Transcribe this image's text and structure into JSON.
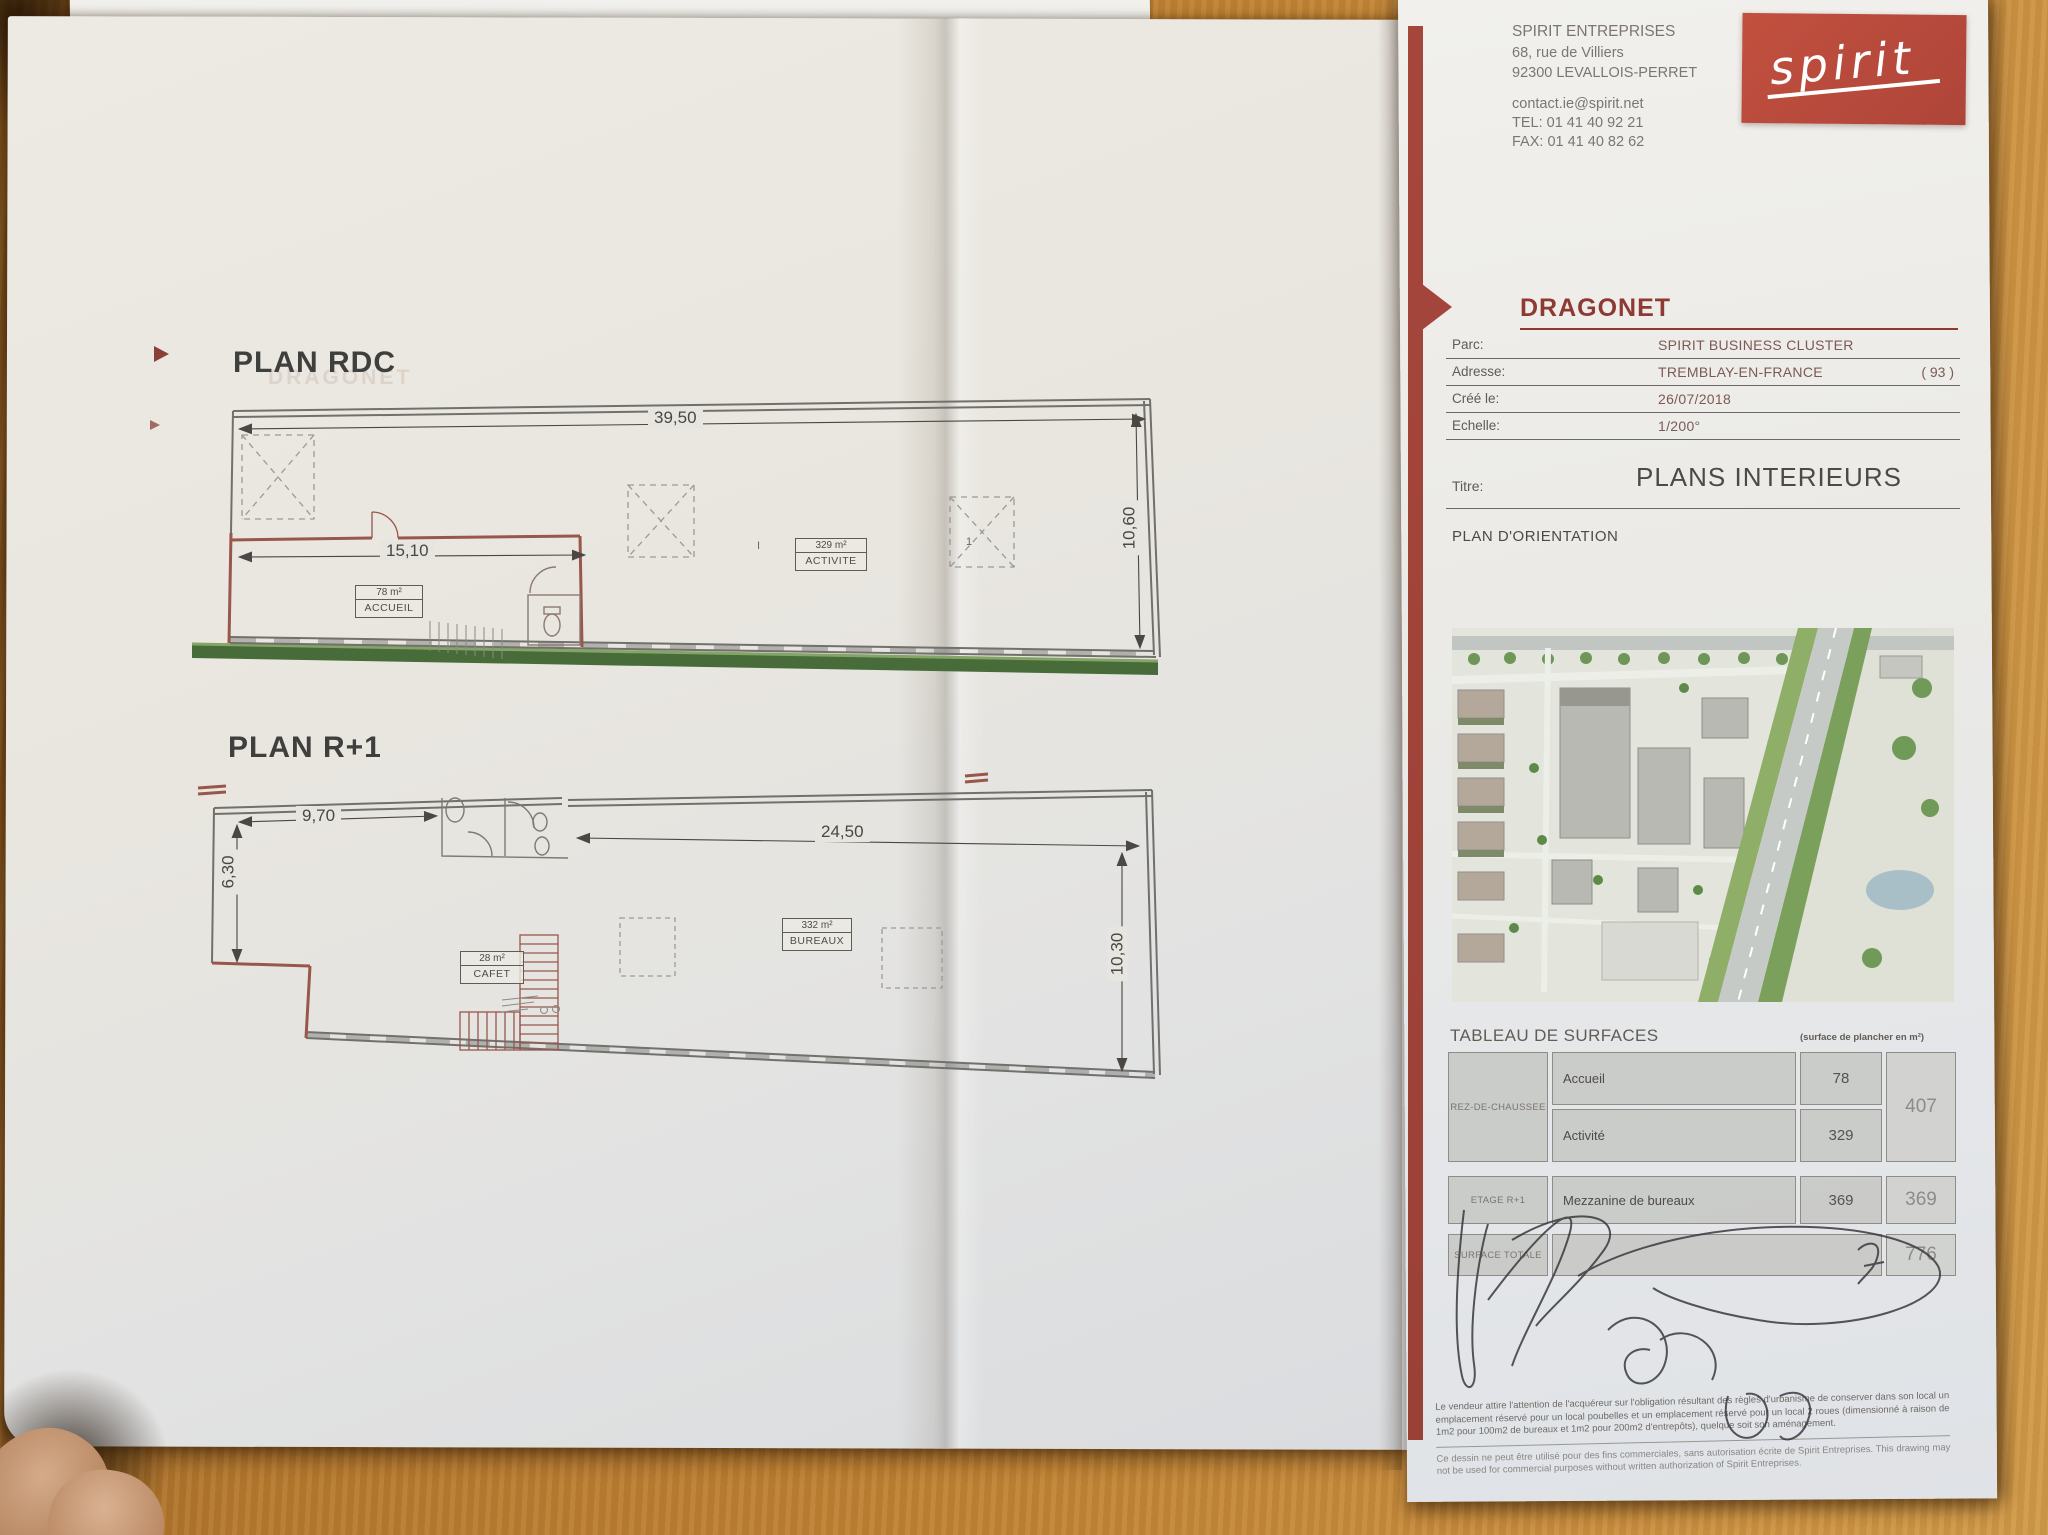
{
  "company": {
    "name": "SPIRIT ENTREPRISES",
    "address1": "68, rue de Villiers",
    "address2": "92300 LEVALLOIS-PERRET",
    "email": "contact.ie@spirit.net",
    "tel": "TEL: 01 41 40 92 21",
    "fax": "FAX: 01 41 40 82 62",
    "logo_text": "spirit"
  },
  "title_block": {
    "project": "DRAGONET",
    "fields": [
      {
        "label": "Parc:",
        "value": "SPIRIT BUSINESS CLUSTER",
        "extra": ""
      },
      {
        "label": "Adresse:",
        "value": "TREMBLAY-EN-FRANCE",
        "extra": "( 93 )"
      },
      {
        "label": "Créé le:",
        "value": "26/07/2018",
        "extra": ""
      },
      {
        "label": "Echelle:",
        "value": "1/200°",
        "extra": ""
      }
    ],
    "titre_label": "Titre:",
    "titre": "PLANS INTERIEURS",
    "orientation": "PLAN D'ORIENTATION"
  },
  "plans": {
    "rdc": {
      "title": "PLAN RDC",
      "dim_top": "39,50",
      "dim_inner": "15,10",
      "dim_right": "10,60",
      "rooms": [
        {
          "area": "78 m²",
          "name": "ACCUEIL"
        },
        {
          "area": "329 m²",
          "name": "ACTIVITE"
        }
      ],
      "grid_marks": {
        "m1": "I",
        "m2": "1"
      }
    },
    "r1": {
      "title": "PLAN R+1",
      "dim_left": "9,70",
      "dim_top": "24,50",
      "dim_side_left": "6,30",
      "dim_side_right": "10,30",
      "rooms": [
        {
          "area": "28 m²",
          "name": "CAFET"
        },
        {
          "area": "332 m²",
          "name": "BUREAUX"
        }
      ]
    }
  },
  "surface_table": {
    "title": "TABLEAU DE SURFACES",
    "unit_note": "(surface de plancher en m²)",
    "groups": [
      {
        "floor": "REZ-DE-CHAUSSEE",
        "rows": [
          {
            "name": "Accueil",
            "value": "78"
          },
          {
            "name": "Activité",
            "value": "329"
          }
        ],
        "subtotal": "407"
      },
      {
        "floor": "ETAGE R+1",
        "rows": [
          {
            "name": "Mezzanine de bureaux",
            "value": "369"
          }
        ],
        "subtotal": "369"
      }
    ],
    "total_label": "SURFACE TOTALE",
    "total": "776"
  },
  "legal": {
    "p1": "Le vendeur attire l'attention de l'acquéreur sur l'obligation résultant des règles d'urbanisme de conserver dans son local un emplacement réservé pour un local poubelles et un emplacement réservé pour un local 2 roues (dimensionné à raison de 1m2 pour 100m2 de bureaux et 1m2 pour 200m2 d'entrepôts), quelque soit son aménagement.",
    "p2": "Ce dessin ne peut être utilisé pour des fins commerciales, sans autorisation écrite de Spirit Entreprises. This drawing may not be used for commercial purposes without written authorization of Spirit Entreprises."
  }
}
